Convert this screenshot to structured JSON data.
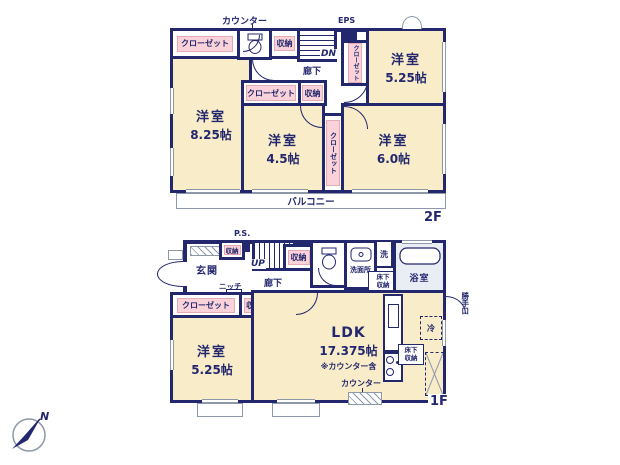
{
  "colors": {
    "wall": "#23276d",
    "room_fill": "#f8ecc9",
    "closet_fill": "#f9d3d9",
    "closet_border": "#e5aab5",
    "bath_fill": "#e9eef4",
    "outline": "#8d98a8",
    "text": "#23276d"
  },
  "compass": {
    "north_label": "N"
  },
  "floor2": {
    "floor_label": "2F",
    "counter_label": "カウンター",
    "eps_label": "EPS",
    "stairs_label": "DN",
    "hallway_label": "廊下",
    "balcony_label": "バルコニー",
    "closet_top_left": "クローゼット",
    "storage_top": "収納",
    "closet_right": "クローゼット",
    "closet_mid": "クローゼット",
    "storage_mid": "収納",
    "closet_mid_right": "クローゼット",
    "room_nw": {
      "name": "洋室",
      "size": "8.25帖"
    },
    "room_ne": {
      "name": "洋室",
      "size": "5.25帖"
    },
    "room_s": {
      "name": "洋室",
      "size": "4.5帖"
    },
    "room_se": {
      "name": "洋室",
      "size": "6.0帖"
    }
  },
  "floor1": {
    "floor_label": "1F",
    "ps_label": "P.S.",
    "entrance_label": "玄関",
    "entrance_storage_label": "収納",
    "stairs_label": "UP",
    "hallway_label": "廊下",
    "niche_label": "ニッチ",
    "hall_storage_label": "収納",
    "washroom_label": "洗面所",
    "washer_label": "洗",
    "underfloor_storage_hall_label": "床下収納",
    "bathroom_label": "浴室",
    "backdoor_label": "勝手口",
    "closet_label": "クローゼット",
    "room_storage_label": "収納",
    "room_w": {
      "name": "洋室",
      "size": "5.25帖"
    },
    "ldk": {
      "name": "LDK",
      "size": "17.375帖",
      "note": "※カウンター含"
    },
    "fridge_label": "冷",
    "underfloor_storage_kitchen_label": "床下収納",
    "counter_label": "カウンター"
  }
}
